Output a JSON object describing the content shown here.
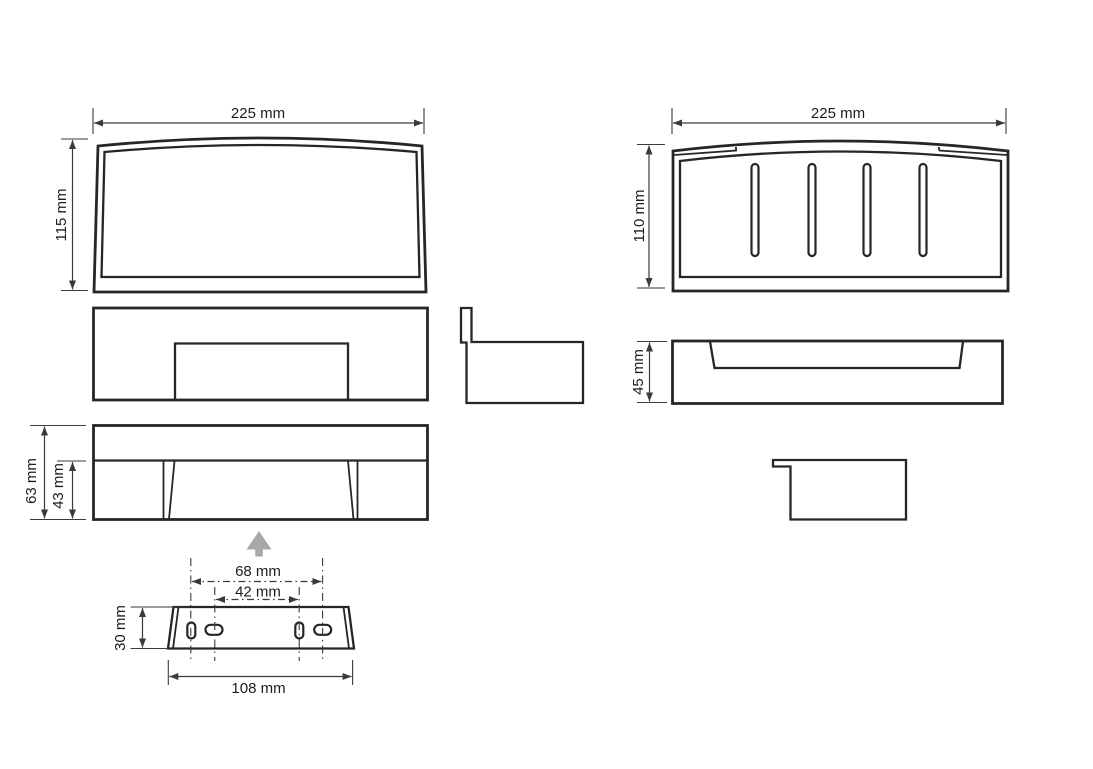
{
  "drawing": {
    "type": "technical-dimension-drawing",
    "views": {
      "front": {
        "width_label": "225 mm",
        "height_label": "115 mm"
      },
      "top": {
        "width_label": "225 mm",
        "depth_label": "110 mm",
        "drain_slot_count": 4
      },
      "side": {
        "height_label": "45 mm"
      },
      "underside": {
        "total_height_label": "63 mm",
        "recess_height_label": "43 mm"
      },
      "bracket": {
        "outer_hole_spacing_label": "68 mm",
        "inner_hole_spacing_label": "42 mm",
        "height_label": "30 mm",
        "width_label": "108 mm",
        "hole_count": 4
      }
    },
    "icons": {
      "mount_direction": "up-arrow"
    },
    "colors": {
      "line": "#262626",
      "dimension": "#3a3a3a",
      "text": "#1d1d1d",
      "arrow_fill": "#a8a8a8",
      "background": "#ffffff"
    }
  }
}
